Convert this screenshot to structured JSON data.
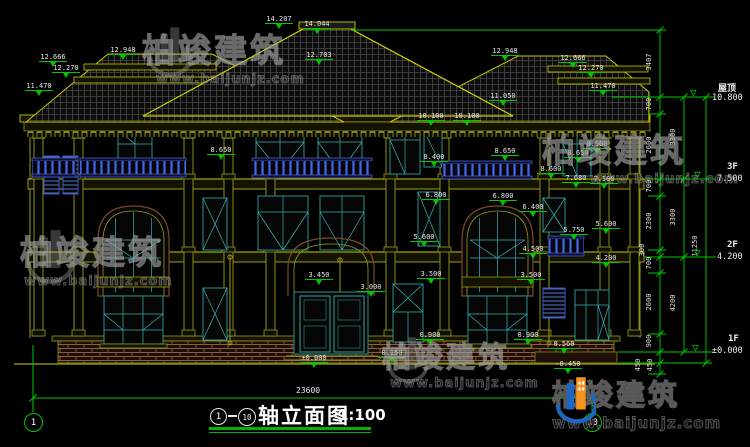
{
  "drawing": {
    "title": {
      "bubble_start": "1",
      "bubble_end": "10",
      "text": "轴立面图",
      "scale": "1:100"
    },
    "axes": {
      "left": "1",
      "right": "10"
    },
    "total_width": "23600"
  },
  "levels": [
    {
      "name": "屋顶",
      "value": "10.800"
    },
    {
      "name": "3F",
      "value": "7.500"
    },
    {
      "name": "2F",
      "value": "4.200"
    },
    {
      "name": "1F",
      "value": "±0.000"
    }
  ],
  "dims": {
    "inner": [
      "700",
      "2600",
      "700",
      "2300",
      "300",
      "700",
      "2600",
      "900",
      "450",
      "450"
    ],
    "middle": [
      "3407",
      "3300",
      "3300",
      "4200"
    ],
    "outer": [
      "11250"
    ]
  },
  "markers": [
    {
      "value": "14.207"
    },
    {
      "value": "14.044"
    },
    {
      "value": "12.703"
    },
    {
      "value": "12.948"
    },
    {
      "value": "12.666"
    },
    {
      "value": "12.270"
    },
    {
      "value": "11.470"
    },
    {
      "value": "12.948"
    },
    {
      "value": "12.666"
    },
    {
      "value": "12.270"
    },
    {
      "value": "11.470"
    },
    {
      "value": "11.050"
    },
    {
      "value": "10.100"
    },
    {
      "value": "10.100"
    },
    {
      "value": "8.900"
    },
    {
      "value": "8.650"
    },
    {
      "value": "8.650"
    },
    {
      "value": "8.400"
    },
    {
      "value": "8.650"
    },
    {
      "value": "8.600"
    },
    {
      "value": "7.680"
    },
    {
      "value": "7.500"
    },
    {
      "value": "6.800"
    },
    {
      "value": "6.800"
    },
    {
      "value": "6.400"
    },
    {
      "value": "5.750"
    },
    {
      "value": "5.600"
    },
    {
      "value": "5.600"
    },
    {
      "value": "4.500"
    },
    {
      "value": "4.200"
    },
    {
      "value": "3.500"
    },
    {
      "value": "3.500"
    },
    {
      "value": "3.450"
    },
    {
      "value": "3.000"
    },
    {
      "value": "0.900"
    },
    {
      "value": "0.900"
    },
    {
      "value": "0.560"
    },
    {
      "value": "0.150"
    },
    {
      "value": "±0.000"
    },
    {
      "value": "-0.450"
    }
  ],
  "watermark": {
    "brand": "柏竣建筑",
    "url": "www.baijunjz.com"
  },
  "colors": {
    "background": "#000000",
    "wall_line": "#9a9a1a",
    "roof_line": "#d0d000",
    "dimension_green": "#00c800",
    "text_white": "#e8e8e8",
    "window_teal": "#39b3b3",
    "balustrade_blue": "#4466ee",
    "arch_brown": "#7a4a28",
    "logo_blue": "#1f66c0",
    "logo_orange": "#f5941e"
  }
}
